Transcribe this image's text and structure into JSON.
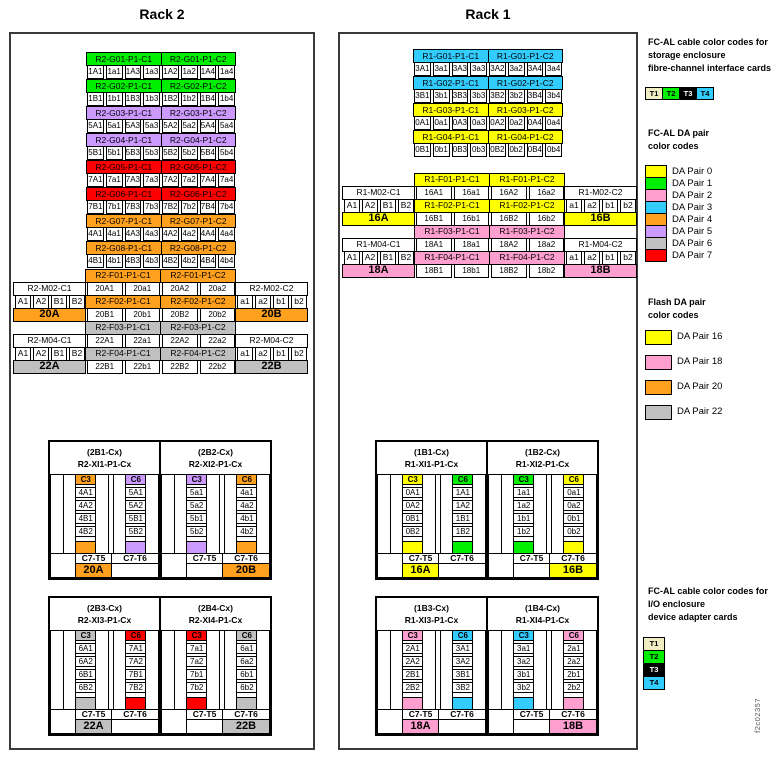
{
  "figure_id": "f2c02357",
  "labels": {
    "c3": "C3",
    "c6": "C6",
    "c7t5": "C7-T5",
    "c7t6": "C7-T6"
  },
  "colors": {
    "green": "#00ee00",
    "purple": "#cc99ff",
    "red": "#ff0000",
    "orange": "#ffa01e",
    "cyan": "#33ccff",
    "yellow": "#ffff00",
    "pink": "#ff9fcf",
    "gray": "#c0c0c0",
    "cream": "#f0edc2",
    "black": "#000000"
  },
  "racks": [
    {
      "id": "rack2",
      "title": "Rack 2",
      "groups": [
        {
          "color": "green",
          "c1": {
            "label": "R2-G01-P1-C1",
            "ports": [
              "1A1",
              "1a1",
              "1A3",
              "1a3"
            ]
          },
          "c2": {
            "label": "R2-G01-P1-C2",
            "ports": [
              "1A2",
              "1a2",
              "1A4",
              "1a4"
            ]
          }
        },
        {
          "color": "green",
          "c1": {
            "label": "R2-G02-P1-C1",
            "ports": [
              "1B1",
              "1b1",
              "1B3",
              "1b3"
            ]
          },
          "c2": {
            "label": "R2-G02-P1-C2",
            "ports": [
              "1B2",
              "1b2",
              "1B4",
              "1b4"
            ]
          }
        },
        {
          "color": "purple",
          "c1": {
            "label": "R2-G03-P1-C1",
            "ports": [
              "5A1",
              "5a1",
              "5A3",
              "5a3"
            ]
          },
          "c2": {
            "label": "R2-G03-P1-C2",
            "ports": [
              "5A2",
              "5a2",
              "5A4",
              "5a4"
            ]
          }
        },
        {
          "color": "purple",
          "c1": {
            "label": "R2-G04-P1-C1",
            "ports": [
              "5B1",
              "5b1",
              "5B3",
              "5b3"
            ]
          },
          "c2": {
            "label": "R2-G04-P1-C2",
            "ports": [
              "5B2",
              "5b2",
              "5B4",
              "5b4"
            ]
          }
        },
        {
          "color": "red",
          "c1": {
            "label": "R2-G05-P1-C1",
            "ports": [
              "7A1",
              "7a1",
              "7A3",
              "7a3"
            ]
          },
          "c2": {
            "label": "R2-G05-P1-C2",
            "ports": [
              "7A2",
              "7a2",
              "7A4",
              "7a4"
            ]
          }
        },
        {
          "color": "red",
          "c1": {
            "label": "R2-G06-P1-C1",
            "ports": [
              "7B1",
              "7b1",
              "7B3",
              "7b3"
            ]
          },
          "c2": {
            "label": "R2-G06-P1-C2",
            "ports": [
              "7B2",
              "7b2",
              "7B4",
              "7b4"
            ]
          }
        },
        {
          "color": "orange",
          "c1": {
            "label": "R2-G07-P1-C1",
            "ports": [
              "4A1",
              "4a1",
              "4A3",
              "4a3"
            ]
          },
          "c2": {
            "label": "R2-G07-P1-C2",
            "ports": [
              "4A2",
              "4a2",
              "4A4",
              "4a4"
            ]
          }
        },
        {
          "color": "orange",
          "c1": {
            "label": "R2-G08-P1-C1",
            "ports": [
              "4B1",
              "4b1",
              "4B3",
              "4b3"
            ]
          },
          "c2": {
            "label": "R2-G08-P1-C2",
            "ports": [
              "4B2",
              "4b2",
              "4B4",
              "4b4"
            ]
          }
        }
      ],
      "mid": {
        "color_a": "orange",
        "color_b": "gray",
        "f01c1": "R2-F01-P1-C1",
        "f01c2": "R2-F01-P1-C2",
        "f02c1": "R2-F02-P1-C1",
        "f02c2": "R2-F02-P1-C2",
        "f03c1": "R2-F03-P1-C1",
        "f03c2": "R2-F03-P1-C2",
        "f04c1": "R2-F04-P1-C1",
        "f04c2": "R2-F04-P1-C2",
        "m02c1": "R2-M02-C1",
        "m02c2": "R2-M02-C2",
        "m04c1": "R2-M04-C1",
        "m04c2": "R2-M04-C2",
        "left_ports": [
          "A1",
          "A2",
          "B1",
          "B2"
        ],
        "right_ports": [
          "a1",
          "a2",
          "b1",
          "b2"
        ],
        "row_a1": [
          "20A1",
          "20a1",
          "20A2",
          "20a2"
        ],
        "row_a2": [
          "20B1",
          "20b1",
          "20B2",
          "20b2"
        ],
        "row_b1": [
          "22A1",
          "22a1",
          "22A2",
          "22a2"
        ],
        "row_b2": [
          "22B1",
          "22b1",
          "22B2",
          "22b2"
        ],
        "big_al": "20A",
        "big_ar": "20B",
        "big_bl": "22A",
        "big_br": "22B"
      },
      "xi_pairs": [
        [
          {
            "slot": "(2B1-Cx)",
            "name": "R2-XI1-P1-Cx",
            "c3_color": "orange",
            "c3_ports": [
              "4A1",
              "4A2",
              "4B1",
              "4B2"
            ],
            "c6_color": "purple",
            "c6_ports": [
              "5A1",
              "5A2",
              "5B1",
              "5B2"
            ],
            "bottom_label": "20A",
            "bottom_color": "orange",
            "bottom_under": "t5"
          },
          {
            "slot": "(2B2-Cx)",
            "name": "R2-XI2-P1-Cx",
            "c3_color": "purple",
            "c3_ports": [
              "5a1",
              "5a2",
              "5b1",
              "5b2"
            ],
            "c6_color": "orange",
            "c6_ports": [
              "4a1",
              "4a2",
              "4b1",
              "4b2"
            ],
            "bottom_label": "20B",
            "bottom_color": "orange",
            "bottom_under": "t6"
          }
        ],
        [
          {
            "slot": "(2B3-Cx)",
            "name": "R2-XI3-P1-Cx",
            "c3_color": "gray",
            "c3_ports": [
              "6A1",
              "6A2",
              "6B1",
              "6B2"
            ],
            "c6_color": "red",
            "c6_ports": [
              "7A1",
              "7A2",
              "7B1",
              "7B2"
            ],
            "bottom_label": "22A",
            "bottom_color": "gray",
            "bottom_under": "t5"
          },
          {
            "slot": "(2B4-Cx)",
            "name": "R2-XI4-P1-Cx",
            "c3_color": "red",
            "c3_ports": [
              "7a1",
              "7a2",
              "7b1",
              "7b2"
            ],
            "c6_color": "gray",
            "c6_ports": [
              "6a1",
              "6a2",
              "6b1",
              "6b2"
            ],
            "bottom_label": "22B",
            "bottom_color": "gray",
            "bottom_under": "t6"
          }
        ]
      ]
    },
    {
      "id": "rack1",
      "title": "Rack 1",
      "groups": [
        {
          "color": "cyan",
          "c1": {
            "label": "R1-G01-P1-C1",
            "ports": [
              "3A1",
              "3a1",
              "3A3",
              "3a3"
            ]
          },
          "c2": {
            "label": "R1-G01-P1-C2",
            "ports": [
              "3A2",
              "3a2",
              "3A4",
              "3a4"
            ]
          }
        },
        {
          "color": "cyan",
          "c1": {
            "label": "R1-G02-P1-C1",
            "ports": [
              "3B1",
              "3b1",
              "3B3",
              "3b3"
            ]
          },
          "c2": {
            "label": "R1-G02-P1-C2",
            "ports": [
              "3B2",
              "3b2",
              "3B4",
              "3b4"
            ]
          }
        },
        {
          "color": "yellow",
          "c1": {
            "label": "R1-G03-P1-C1",
            "ports": [
              "0A1",
              "0a1",
              "0A3",
              "0a3"
            ]
          },
          "c2": {
            "label": "R1-G03-P1-C2",
            "ports": [
              "0A2",
              "0a2",
              "0A4",
              "0a4"
            ]
          }
        },
        {
          "color": "yellow",
          "c1": {
            "label": "R1-G04-P1-C1",
            "ports": [
              "0B1",
              "0b1",
              "0B3",
              "0b3"
            ]
          },
          "c2": {
            "label": "R1-G04-P1-C2",
            "ports": [
              "0B2",
              "0b2",
              "0B4",
              "0b4"
            ]
          }
        }
      ],
      "mid": {
        "color_a": "yellow",
        "color_b": "pink",
        "f01c1": "R1-F01-P1-C1",
        "f01c2": "R1-F01-P1-C2",
        "f02c1": "R1-F02-P1-C1",
        "f02c2": "R1-F02-P1-C2",
        "f03c1": "R1-F03-P1-C1",
        "f03c2": "R1-F03-P1-C2",
        "f04c1": "R1-F04-P1-C1",
        "f04c2": "R1-F04-P1-C2",
        "m02c1": "R1-M02-C1",
        "m02c2": "R1-M02-C2",
        "m04c1": "R1-M04-C1",
        "m04c2": "R1-M04-C2",
        "left_ports": [
          "A1",
          "A2",
          "B1",
          "B2"
        ],
        "right_ports": [
          "a1",
          "a2",
          "b1",
          "b2"
        ],
        "row_a1": [
          "16A1",
          "16a1",
          "16A2",
          "16a2"
        ],
        "row_a2": [
          "16B1",
          "16b1",
          "16B2",
          "16b2"
        ],
        "row_b1": [
          "18A1",
          "18a1",
          "18A2",
          "18a2"
        ],
        "row_b2": [
          "18B1",
          "18b1",
          "18B2",
          "18b2"
        ],
        "big_al": "16A",
        "big_ar": "16B",
        "big_bl": "18A",
        "big_br": "18B"
      },
      "xi_pairs": [
        [
          {
            "slot": "(1B1-Cx)",
            "name": "R1-XI1-P1-Cx",
            "c3_color": "yellow",
            "c3_ports": [
              "0A1",
              "0A2",
              "0B1",
              "0B2"
            ],
            "c6_color": "green",
            "c6_ports": [
              "1A1",
              "1A2",
              "1B1",
              "1B2"
            ],
            "bottom_label": "16A",
            "bottom_color": "yellow",
            "bottom_under": "t5"
          },
          {
            "slot": "(1B2-Cx)",
            "name": "R1-XI2-P1-Cx",
            "c3_color": "green",
            "c3_ports": [
              "1a1",
              "1a2",
              "1b1",
              "1b2"
            ],
            "c6_color": "yellow",
            "c6_ports": [
              "0a1",
              "0a2",
              "0b1",
              "0b2"
            ],
            "bottom_label": "16B",
            "bottom_color": "yellow",
            "bottom_under": "t6"
          }
        ],
        [
          {
            "slot": "(1B3-Cx)",
            "name": "R1-XI3-P1-Cx",
            "c3_color": "pink",
            "c3_ports": [
              "2A1",
              "2A2",
              "2B1",
              "2B2"
            ],
            "c6_color": "cyan",
            "c6_ports": [
              "3A1",
              "3A2",
              "3B1",
              "3B2"
            ],
            "bottom_label": "18A",
            "bottom_color": "pink",
            "bottom_under": "t5"
          },
          {
            "slot": "(1B4-Cx)",
            "name": "R1-XI4-P1-Cx",
            "c3_color": "cyan",
            "c3_ports": [
              "3a1",
              "3a2",
              "3b1",
              "3b2"
            ],
            "c6_color": "pink",
            "c6_ports": [
              "2a1",
              "2a2",
              "2b1",
              "2b2"
            ],
            "bottom_label": "18B",
            "bottom_color": "pink",
            "bottom_under": "t6"
          }
        ]
      ]
    }
  ],
  "legend": {
    "storage_title": [
      "FC-AL cable color codes for",
      "storage enclosure",
      "fibre-channel interface cards"
    ],
    "t_cards": [
      {
        "label": "T1",
        "color": "cream",
        "text_color": "#000000"
      },
      {
        "label": "T2",
        "color": "green",
        "text_color": "#000000"
      },
      {
        "label": "T3",
        "color": "black",
        "text_color": "#ffffff"
      },
      {
        "label": "T4",
        "color": "cyan",
        "text_color": "#000000"
      }
    ],
    "da_title": [
      "FC-AL DA pair",
      "color codes"
    ],
    "da_pairs": [
      {
        "label": "DA Pair 0",
        "color": "yellow"
      },
      {
        "label": "DA Pair 1",
        "color": "green"
      },
      {
        "label": "DA Pair 2",
        "color": "pink"
      },
      {
        "label": "DA Pair 3",
        "color": "cyan"
      },
      {
        "label": "DA Pair 4",
        "color": "orange"
      },
      {
        "label": "DA Pair 5",
        "color": "purple"
      },
      {
        "label": "DA Pair 6",
        "color": "gray"
      },
      {
        "label": "DA Pair 7",
        "color": "red"
      }
    ],
    "flash_title": [
      "Flash DA pair",
      "color codes"
    ],
    "flash_pairs": [
      {
        "label": "DA Pair 16",
        "color": "yellow"
      },
      {
        "label": "DA Pair 18",
        "color": "pink"
      },
      {
        "label": "DA Pair 20",
        "color": "orange"
      },
      {
        "label": "DA Pair 22",
        "color": "gray"
      }
    ],
    "io_title": [
      "FC-AL cable color codes for",
      "I/O enclosure",
      "device adapter cards"
    ]
  }
}
